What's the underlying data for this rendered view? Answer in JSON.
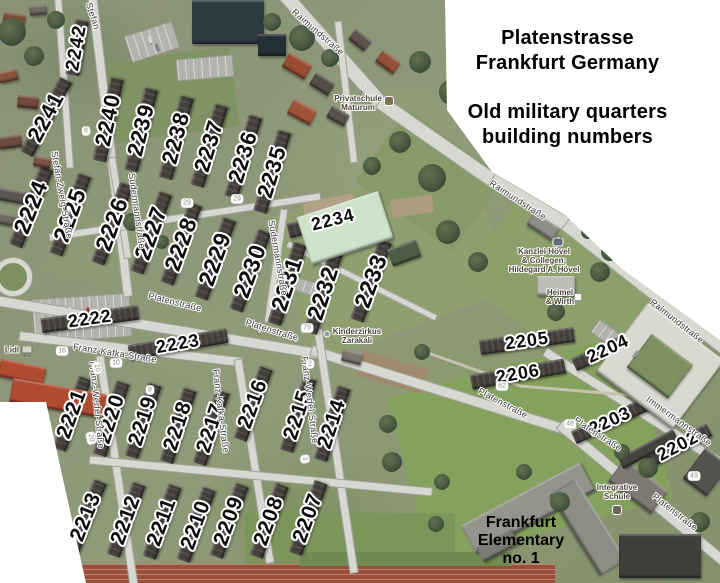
{
  "title": {
    "line1": "Platenstrasse",
    "line2": "Frankfurt Germany",
    "line3": "Old military quarters",
    "line4": "building numbers"
  },
  "overlay_labels": {
    "frankfurt_elementary": {
      "lines": [
        "Frankfurt",
        "Elementary",
        "no. 1"
      ],
      "x": 521,
      "y": 541
    }
  },
  "building_numbers": [
    {
      "label": "2242",
      "x": 77,
      "y": 48,
      "rot": -80,
      "size": 19
    },
    {
      "label": "2241",
      "x": 46,
      "y": 117,
      "rot": -62,
      "size": 22
    },
    {
      "label": "2240",
      "x": 108,
      "y": 120,
      "rot": -78,
      "size": 22
    },
    {
      "label": "2239",
      "x": 141,
      "y": 130,
      "rot": -76,
      "size": 22
    },
    {
      "label": "2238",
      "x": 176,
      "y": 138,
      "rot": -75,
      "size": 22
    },
    {
      "label": "2237",
      "x": 209,
      "y": 146,
      "rot": -73,
      "size": 22
    },
    {
      "label": "2236",
      "x": 243,
      "y": 157,
      "rot": -73,
      "size": 22
    },
    {
      "label": "2235",
      "x": 272,
      "y": 172,
      "rot": -73,
      "size": 22
    },
    {
      "label": "2224",
      "x": 31,
      "y": 207,
      "rot": -68,
      "size": 23
    },
    {
      "label": "2225",
      "x": 70,
      "y": 215,
      "rot": -70,
      "size": 23
    },
    {
      "label": "2226",
      "x": 112,
      "y": 224,
      "rot": -70,
      "size": 23
    },
    {
      "label": "2227",
      "x": 151,
      "y": 233,
      "rot": -70,
      "size": 23
    },
    {
      "label": "2228",
      "x": 181,
      "y": 244,
      "rot": -70,
      "size": 23
    },
    {
      "label": "2229",
      "x": 215,
      "y": 259,
      "rot": -70,
      "size": 23
    },
    {
      "label": "2230",
      "x": 250,
      "y": 271,
      "rot": -70,
      "size": 23
    },
    {
      "label": "2231",
      "x": 287,
      "y": 284,
      "rot": -72,
      "size": 23
    },
    {
      "label": "2232",
      "x": 323,
      "y": 293,
      "rot": -72,
      "size": 23
    },
    {
      "label": "2233",
      "x": 371,
      "y": 281,
      "rot": -70,
      "size": 23
    },
    {
      "label": "2234",
      "x": 333,
      "y": 220,
      "rot": -14,
      "size": 18
    },
    {
      "label": "2222",
      "x": 90,
      "y": 319,
      "rot": -8,
      "size": 18
    },
    {
      "label": "2223",
      "x": 178,
      "y": 344,
      "rot": -10,
      "size": 18
    },
    {
      "label": "2205",
      "x": 527,
      "y": 341,
      "rot": -8,
      "size": 18
    },
    {
      "label": "2204",
      "x": 608,
      "y": 349,
      "rot": -25,
      "size": 18
    },
    {
      "label": "2206",
      "x": 518,
      "y": 374,
      "rot": -10,
      "size": 18
    },
    {
      "label": "2203",
      "x": 610,
      "y": 421,
      "rot": -25,
      "size": 18
    },
    {
      "label": "2202",
      "x": 678,
      "y": 446,
      "rot": -28,
      "size": 18
    },
    {
      "label": "2221",
      "x": 72,
      "y": 414,
      "rot": -70,
      "size": 21
    },
    {
      "label": "2220",
      "x": 111,
      "y": 419,
      "rot": -72,
      "size": 21
    },
    {
      "label": "2219",
      "x": 143,
      "y": 421,
      "rot": -72,
      "size": 21
    },
    {
      "label": "2218",
      "x": 178,
      "y": 426,
      "rot": -72,
      "size": 21
    },
    {
      "label": "2217",
      "x": 211,
      "y": 428,
      "rot": -72,
      "size": 21
    },
    {
      "label": "2216",
      "x": 253,
      "y": 404,
      "rot": -70,
      "size": 21
    },
    {
      "label": "2215",
      "x": 298,
      "y": 415,
      "rot": -72,
      "size": 21
    },
    {
      "label": "2214",
      "x": 332,
      "y": 424,
      "rot": -72,
      "size": 21
    },
    {
      "label": "2213",
      "x": 86,
      "y": 517,
      "rot": -68,
      "size": 21
    },
    {
      "label": "2212",
      "x": 126,
      "y": 520,
      "rot": -70,
      "size": 21
    },
    {
      "label": "2211",
      "x": 162,
      "y": 522,
      "rot": -70,
      "size": 21
    },
    {
      "label": "2210",
      "x": 196,
      "y": 525,
      "rot": -70,
      "size": 21
    },
    {
      "label": "2209",
      "x": 229,
      "y": 521,
      "rot": -70,
      "size": 21
    },
    {
      "label": "2208",
      "x": 269,
      "y": 521,
      "rot": -70,
      "size": 21
    },
    {
      "label": "2207",
      "x": 308,
      "y": 518,
      "rot": -70,
      "size": 21
    }
  ],
  "street_labels": [
    {
      "text": "Raimundstraße",
      "x": 318,
      "y": 32,
      "rot": 41
    },
    {
      "text": "Raimundstraße",
      "x": 518,
      "y": 200,
      "rot": 33
    },
    {
      "text": "Raimundstraße",
      "x": 677,
      "y": 321,
      "rot": 38
    },
    {
      "text": "Platenstraße",
      "x": 175,
      "y": 302,
      "rot": 14
    },
    {
      "text": "Platenstraße",
      "x": 272,
      "y": 330,
      "rot": 17
    },
    {
      "text": "Platenstraße",
      "x": 503,
      "y": 403,
      "rot": 28
    },
    {
      "text": "Platenstraße",
      "x": 598,
      "y": 434,
      "rot": 33
    },
    {
      "text": "Platenstraße",
      "x": 675,
      "y": 512,
      "rot": 38
    },
    {
      "text": "Stefan",
      "x": 93,
      "y": 16,
      "rot": 72
    },
    {
      "text": "Stefan-Zweig-Straße",
      "x": 62,
      "y": 195,
      "rot": 80
    },
    {
      "text": "Sudermannstraße",
      "x": 137,
      "y": 211,
      "rot": 82
    },
    {
      "text": "Sudermannstraße",
      "x": 278,
      "y": 258,
      "rot": 80
    },
    {
      "text": "Franz-Kafka-Straße",
      "x": 115,
      "y": 353,
      "rot": 9
    },
    {
      "text": "Franz-Kafka-Straße",
      "x": 221,
      "y": 411,
      "rot": 83
    },
    {
      "text": "Franz-Werfel-Straße",
      "x": 97,
      "y": 405,
      "rot": 84
    },
    {
      "text": "Franz-Werfel-Straße",
      "x": 310,
      "y": 400,
      "rot": 83
    },
    {
      "text": "Immermannstraße",
      "x": 679,
      "y": 421,
      "rot": 36
    }
  ],
  "poi_labels": [
    {
      "lines": [
        "Privatschule",
        "Maturum"
      ],
      "x": 358,
      "y": 103,
      "icon": "school",
      "icon_dx": 31,
      "icon_dy": -2
    },
    {
      "lines": [
        "Kinderzirkus",
        "Zarakali"
      ],
      "x": 357,
      "y": 336,
      "icon": "dot",
      "icon_dx": -30,
      "icon_dy": -2
    },
    {
      "lines": [
        "Kanzlei Hövel",
        "& Collegen;",
        "Hildegard A. Hövel"
      ],
      "x": 544,
      "y": 261,
      "icon": "briefcase",
      "icon_dx": 14,
      "icon_dy": -19
    },
    {
      "lines": [
        "Heimel",
        "& Wirth"
      ],
      "x": 560,
      "y": 297,
      "icon": "box",
      "icon_dx": 18,
      "icon_dy": 0
    },
    {
      "lines": [
        "Integrative",
        "Schule"
      ],
      "x": 617,
      "y": 492,
      "icon": "school2",
      "icon_dx": 0,
      "icon_dy": 18
    },
    {
      "lines": [
        "Lidl"
      ],
      "x": 12,
      "y": 350,
      "icon": "cart",
      "icon_dx": 15,
      "icon_dy": 0
    }
  ],
  "house_number_markers": [
    {
      "text": "29",
      "x": 187,
      "y": 203,
      "rot": 0
    },
    {
      "text": "29",
      "x": 237,
      "y": 199,
      "rot": 0
    },
    {
      "text": "79",
      "x": 307,
      "y": 328,
      "rot": 0
    },
    {
      "text": "16",
      "x": 62,
      "y": 351,
      "rot": 0
    },
    {
      "text": "10",
      "x": 116,
      "y": 363,
      "rot": 0
    },
    {
      "text": "20",
      "x": 97,
      "y": 368,
      "rot": 78
    },
    {
      "text": "20",
      "x": 91,
      "y": 438,
      "rot": 78
    },
    {
      "text": "8",
      "x": 150,
      "y": 390,
      "rot": 0
    },
    {
      "text": "8",
      "x": 86,
      "y": 131,
      "rot": 0
    },
    {
      "text": "2",
      "x": 310,
      "y": 364,
      "rot": 0
    },
    {
      "text": "2",
      "x": 305,
      "y": 459,
      "rot": 78
    },
    {
      "text": "62",
      "x": 502,
      "y": 386,
      "rot": 0
    },
    {
      "text": "48",
      "x": 570,
      "y": 424,
      "rot": 0
    },
    {
      "text": "49",
      "x": 694,
      "y": 476,
      "rot": 0
    }
  ],
  "colors": {
    "annotation_text": "#0d0d0d",
    "annotation_halo": "#ffffff",
    "title_text": "#000000",
    "road_fill": "#d7d8d2",
    "grass_base": "#8b9276",
    "building_roof": "#423f3b",
    "white_panel": "#ffffff"
  }
}
